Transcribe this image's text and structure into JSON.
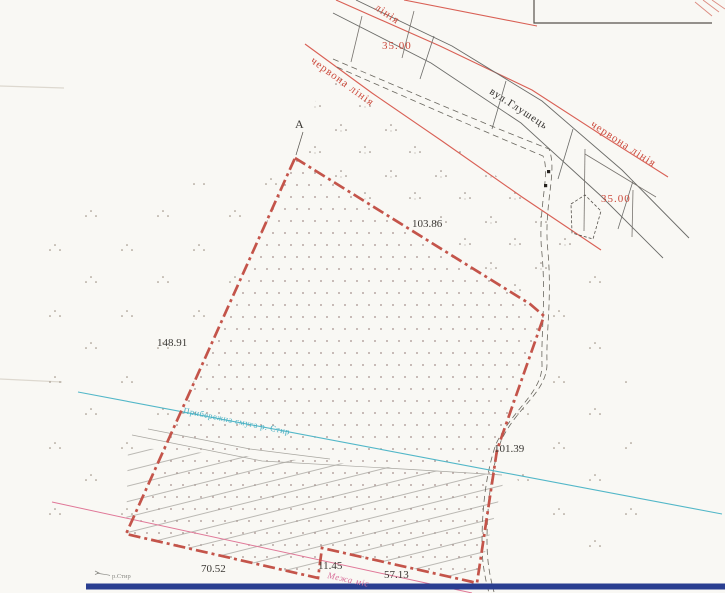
{
  "labels": {
    "corner_point": "А",
    "street_name": "вул.Глушець",
    "red_line_partial": "лінія",
    "red_line_left": "червона лінія",
    "red_line_right": "червона лінія",
    "street_width_top": "35.00",
    "street_width_right": "35.00"
  },
  "dimensions": {
    "north_side": "103.86",
    "west_side": "148.91",
    "east_side": "101.39",
    "south_side_west": "70.52",
    "south_step": "11.45",
    "south_side_east": "57.13"
  },
  "annotations": {
    "coastal_strip": "Прибережна смуга р. Стир",
    "city_boundary_partial": "Межа міс",
    "river_name": "р.Стир"
  },
  "colors": {
    "parcel_boundary": "#c4544a",
    "red_line": "#d96055",
    "coastal_line": "#52b7c8",
    "city_boundary_line": "#e07898",
    "footer_bar": "#2a3e90",
    "ink": "#3a3733"
  }
}
